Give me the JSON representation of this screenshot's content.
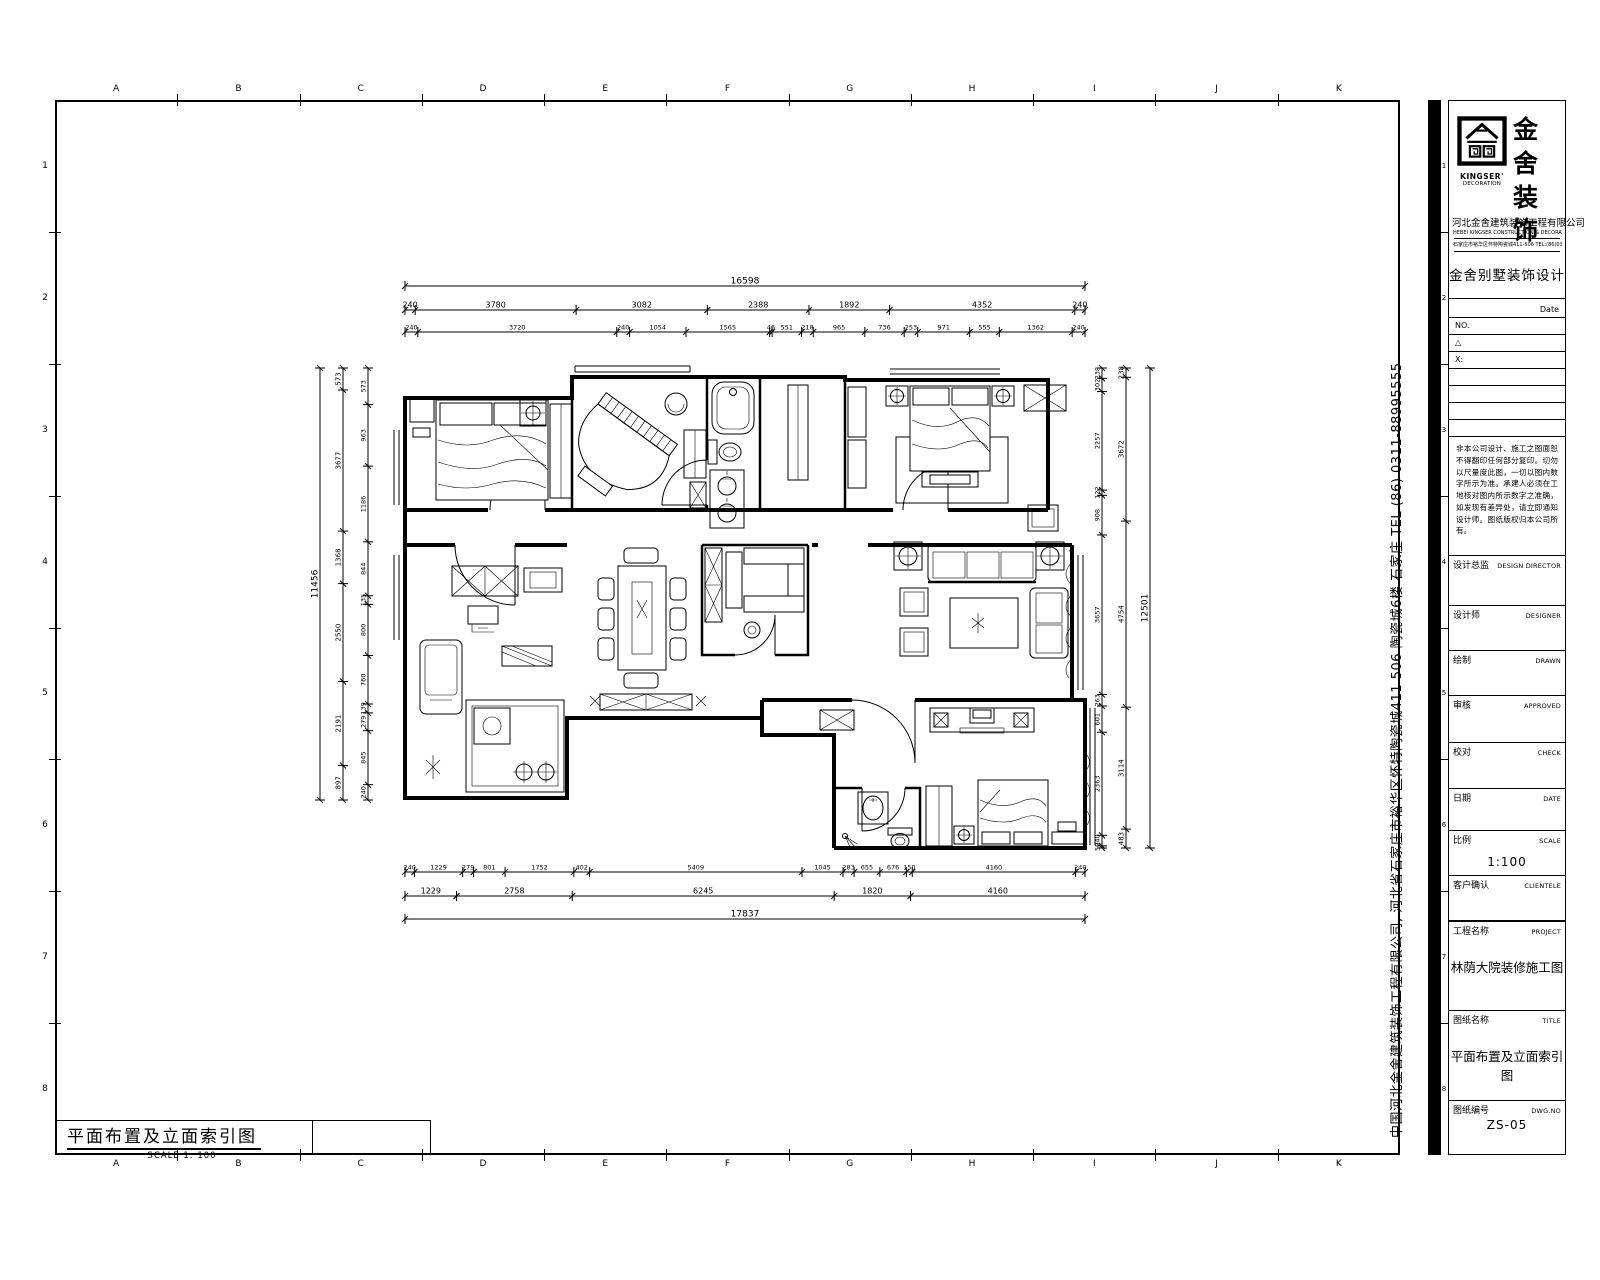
{
  "sheet": {
    "grid_letters": [
      "A",
      "B",
      "C",
      "D",
      "E",
      "F",
      "G",
      "H",
      "I",
      "J",
      "K"
    ],
    "grid_numbers": [
      "1",
      "2",
      "3",
      "4",
      "5",
      "6",
      "7",
      "8"
    ]
  },
  "drawing_label": {
    "title": "平面布置及立面索引图",
    "scale": "SCALE 1: 100"
  },
  "side_strip": {
    "text": "中国河北金舍建筑装饰工程有限公司, 河北省石家庄市裕华区怀特陶瓷城411 506 陶瓷城6楼 石家庄 TEL (86) 0311-88995555"
  },
  "titleblock": {
    "brand": {
      "name_cn_line1": "金舍",
      "name_cn_line2": "装饰",
      "name_en_line1": "KINGSER'",
      "name_en_line2": "DECORATION"
    },
    "company": "河北金舍建筑装饰工程有限公司",
    "address_en": "HEBEI KINGSER CONSTRUCTION & DECORATION ENGINEERING CO.,LTD.",
    "address_cn": "石家庄市裕华区怀特陶瓷城411-506  TEL:(86)0311-88995555",
    "design_title": "金舍别墅装饰设计",
    "date_label": "Date",
    "no_label": "NO.",
    "rev_label": "△",
    "x_label": "X:",
    "notice": "非本公司设计、施工之图面恕不得翻印任何部分复印。切勿以尺量度此图，一切以图内数字所示为准。承建人必须在工地核对图内所示数字之准确，如发现有差异处，请立即通知设计师。图纸版权归本公司所有。",
    "fields": [
      {
        "cn": "设计总监",
        "en": "DESIGN DIRECTOR",
        "value": ""
      },
      {
        "cn": "设计师",
        "en": "DESIGNER",
        "value": ""
      },
      {
        "cn": "绘制",
        "en": "DRAWN",
        "value": ""
      },
      {
        "cn": "审核",
        "en": "APPROVED",
        "value": ""
      },
      {
        "cn": "校对",
        "en": "CHECK",
        "value": ""
      },
      {
        "cn": "日期",
        "en": "DATE",
        "value": ""
      },
      {
        "cn": "比例",
        "en": "SCALE",
        "value": "1:100"
      },
      {
        "cn": "客户确认",
        "en": "CLIENTELE",
        "value": ""
      },
      {
        "cn": "工程名称",
        "en": "PROJECT",
        "value": "林荫大院装修施工图"
      },
      {
        "cn": "图纸名称",
        "en": "TITLE",
        "value": "平面布置及立面索引图"
      },
      {
        "cn": "图纸编号",
        "en": "DWG.NO",
        "value": "ZS-05"
      }
    ]
  },
  "dimensions": {
    "top": {
      "overall": "16598",
      "row1": [
        "240",
        "3780",
        "3082",
        "2388",
        "1892",
        "4352",
        "240"
      ],
      "row2": [
        "240",
        "3720",
        "240",
        "1054",
        "1565",
        "46",
        "551",
        "218",
        "965",
        "736",
        "253",
        "971",
        "555",
        "1362",
        "240"
      ]
    },
    "bottom": {
      "overall": "17837",
      "row1": [
        "240",
        "1229",
        "279",
        "801",
        "1752",
        "402",
        "5409",
        "1045",
        "283",
        "655",
        "676",
        "150",
        "4160",
        "240"
      ],
      "row2": [
        "1229",
        "2758",
        "6245",
        "1820",
        "4160"
      ]
    },
    "left": {
      "overall": "11456",
      "outer": [
        "573",
        "3677",
        "1368",
        "2550",
        "2191",
        "897"
      ],
      "inner": [
        "573",
        "963",
        "1186",
        "844",
        "135",
        "800",
        "760",
        "139",
        "279",
        "845",
        "240"
      ]
    },
    "right": {
      "overall": "12501",
      "inner": [
        "238",
        "302",
        "2257",
        "122",
        "908",
        "3657",
        "263",
        "601",
        "2363",
        "240",
        "50"
      ],
      "outer": [
        "238",
        "3672",
        "4754",
        "3114",
        "483"
      ]
    }
  }
}
